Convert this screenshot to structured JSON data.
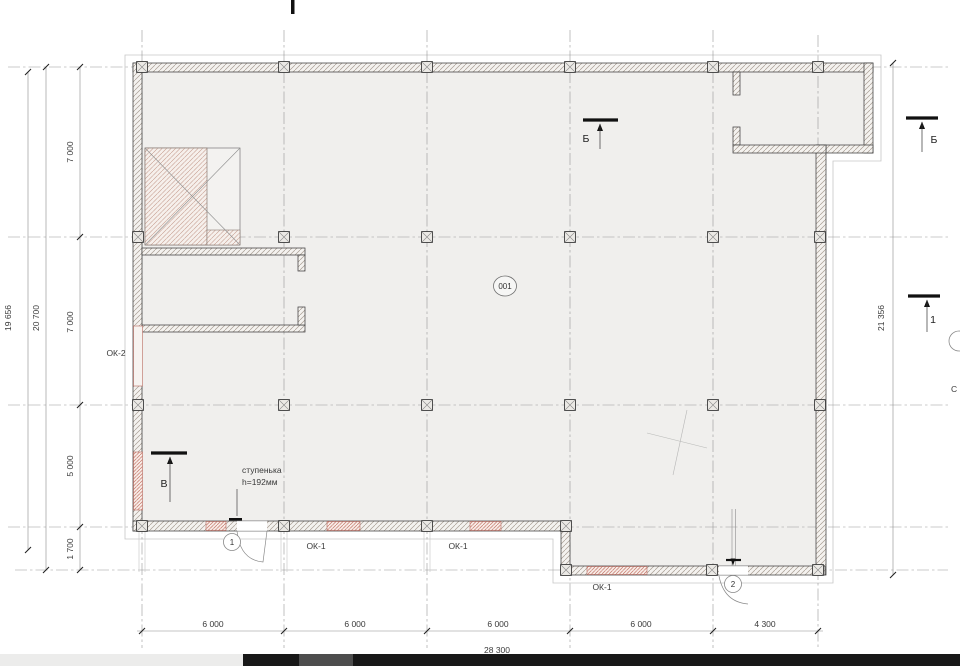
{
  "plan": {
    "room_badge": "001",
    "section_markers": {
      "top_b": "Б",
      "right_b": "Б",
      "right_1": "1",
      "left_v": "В"
    },
    "door_badges": [
      "1",
      "2"
    ],
    "window_labels": {
      "ok2": "ОК-2",
      "ok1": [
        "ОК-1",
        "ОК-1",
        "ОК-1"
      ]
    },
    "step_note": {
      "line1": "ступенька",
      "line2": "h=192мм"
    },
    "dimensions": {
      "left_outer_total": "19 656",
      "left_total": "20 700",
      "left_segments": [
        "7 000",
        "7 000",
        "5 000",
        "1 700"
      ],
      "right_total": "21 356",
      "bottom_segments": [
        "6 000",
        "6 000",
        "6 000",
        "6 000",
        "4 300"
      ],
      "bottom_total": "28 300"
    },
    "edge_label_partial": "С",
    "colors": {
      "red_accent": "#c4766a",
      "wall_line": "#3f3f3f",
      "grid_line": "#979797",
      "floor_fill": "#f0efed",
      "taskbar": "#181818"
    }
  }
}
